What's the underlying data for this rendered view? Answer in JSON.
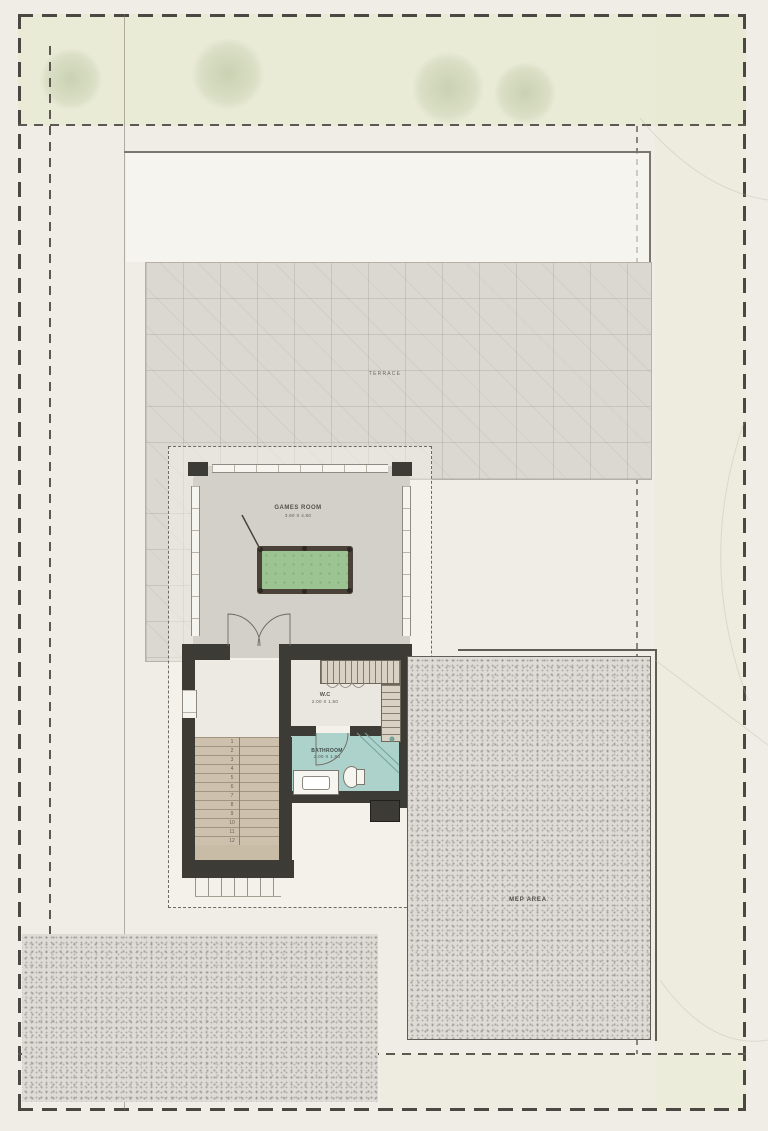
{
  "colors": {
    "background": "#f0ede7",
    "boundary": "#4b4843",
    "wall": "#3d3b36",
    "terrace_fill": "#dbd8d2",
    "room_floor": "#d3d0c9",
    "pool_felt": "#9cc493",
    "pool_frame": "#4a4138",
    "bath_floor": "#acd2cb",
    "stair_tread": "#cdc1ad",
    "stipple_fill": "#dedbd6",
    "label": "#55504a"
  },
  "labels": {
    "terrace": "TERRACE",
    "games_room": {
      "name": "GAMES ROOM",
      "dims": "3.90 X 4.80"
    },
    "wc": {
      "name": "W.C",
      "dims": "2.00 X 1.50"
    },
    "bathroom": {
      "name": "BATHROOM",
      "dims": "2.00 X 1.80"
    },
    "mep": "MEP AREA"
  },
  "stairs": {
    "steps": [
      "1",
      "2",
      "3",
      "4",
      "5",
      "6",
      "7",
      "8",
      "9",
      "10",
      "11",
      "12"
    ]
  }
}
